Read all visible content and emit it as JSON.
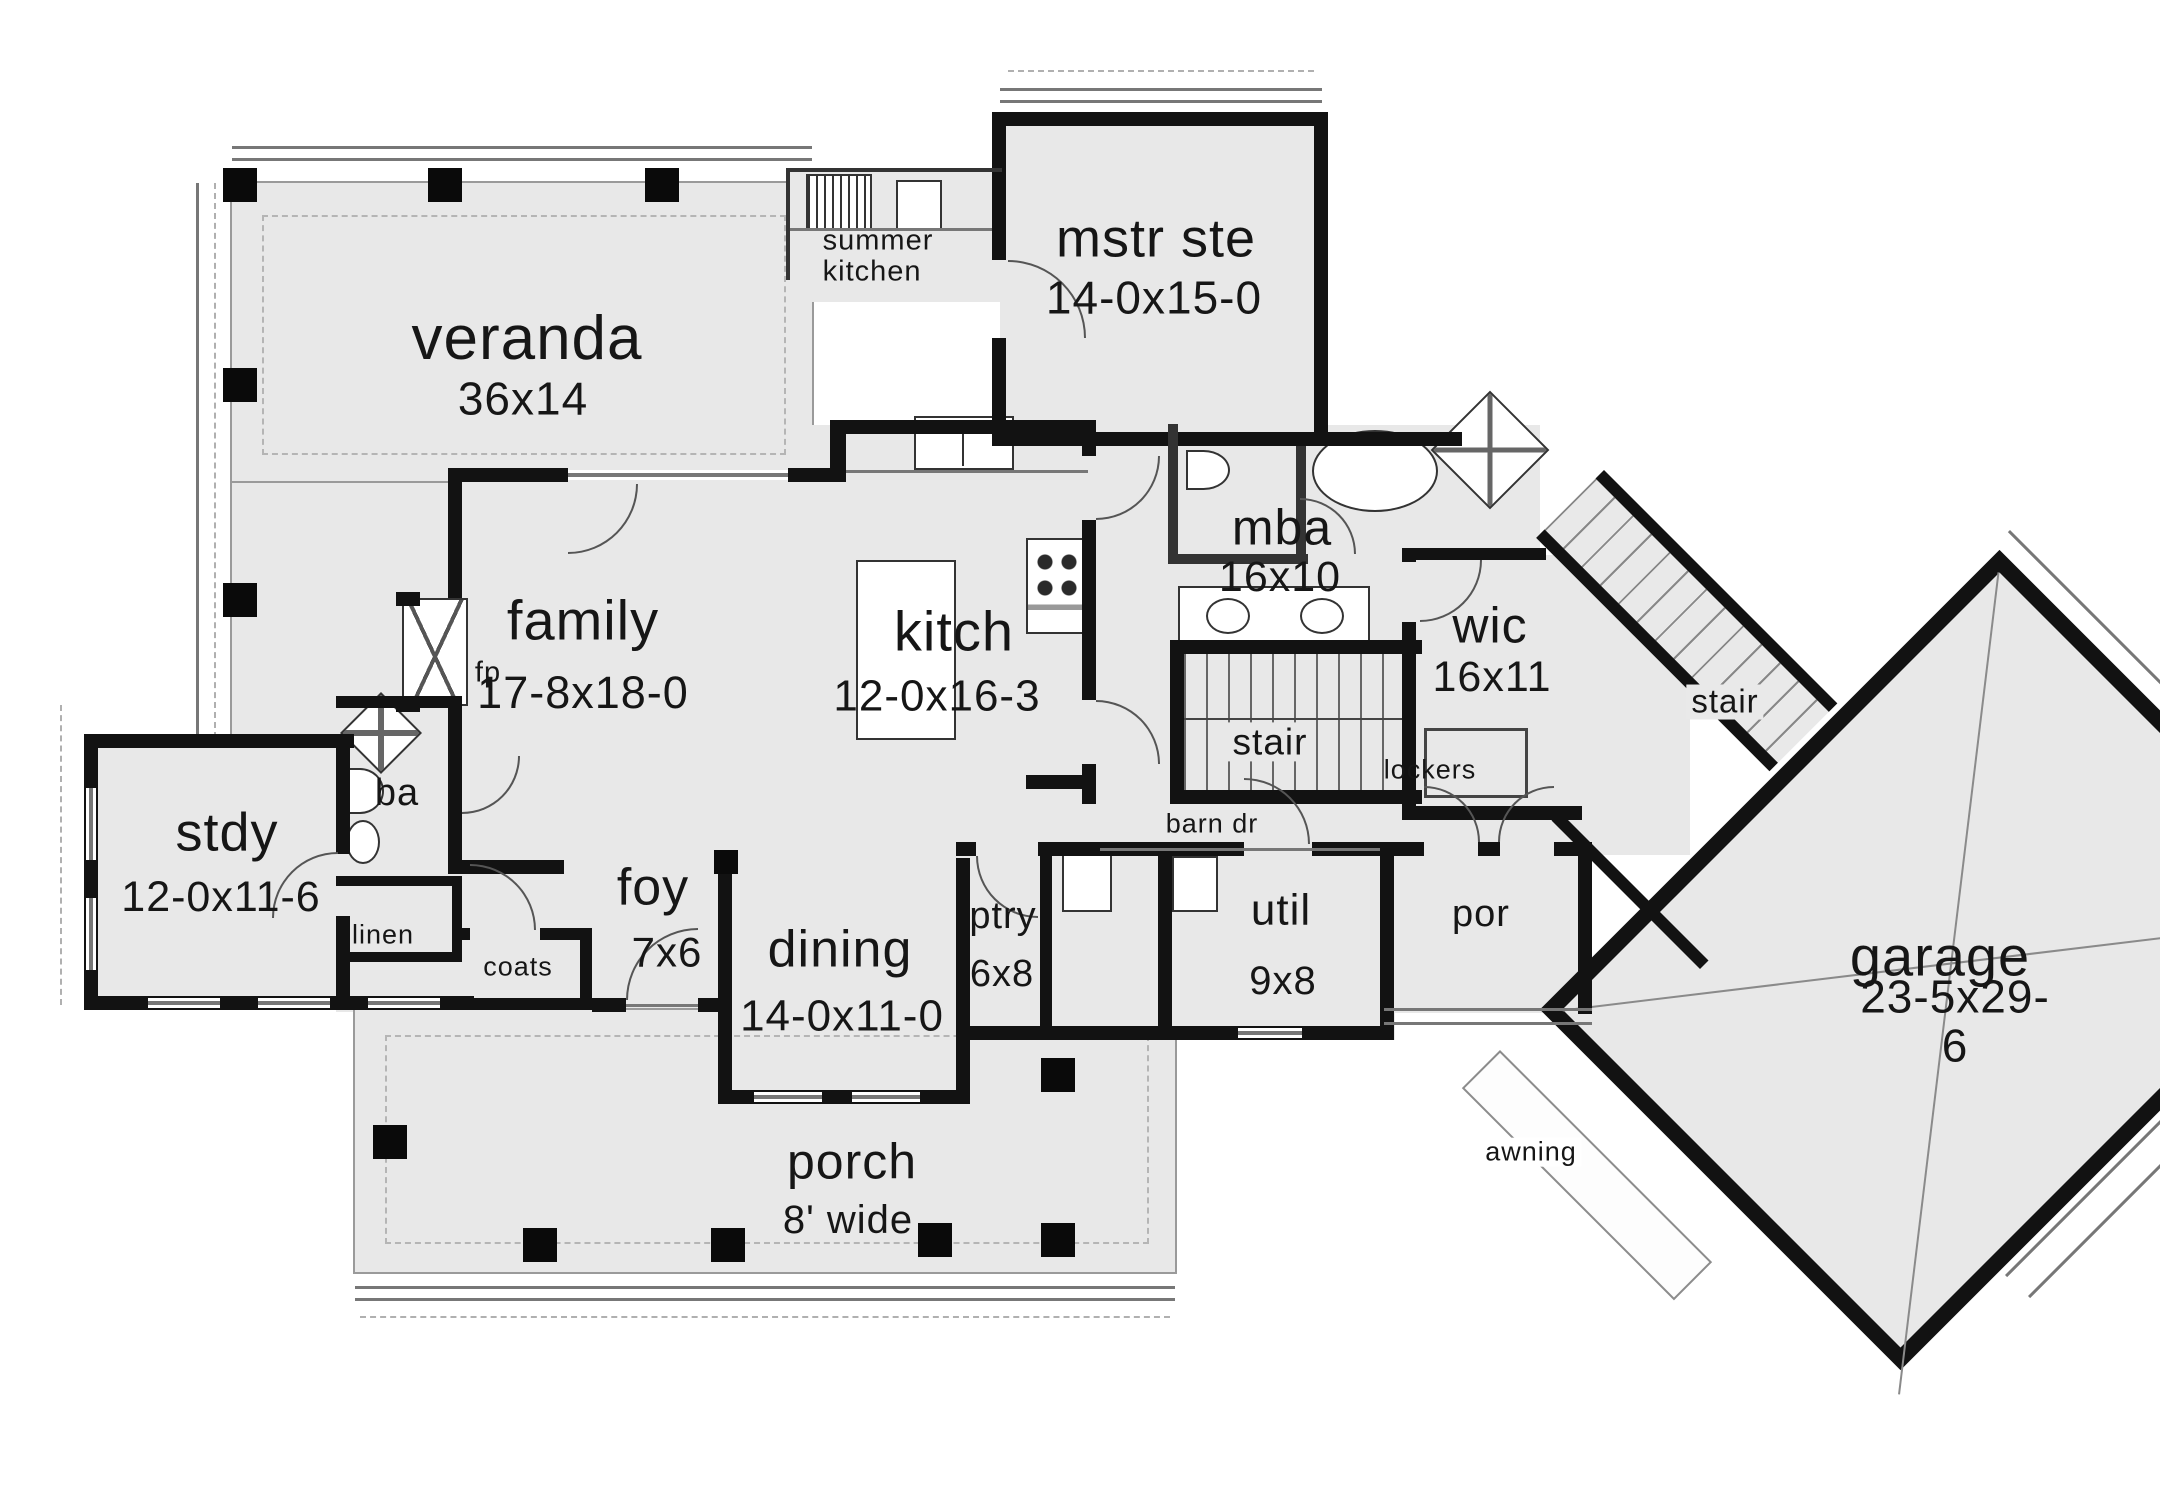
{
  "colors": {
    "background": "#ffffff",
    "room_fill": "#e8e8e8",
    "wall": "#121212",
    "thin_line": "#777777",
    "text": "#161616"
  },
  "rooms": {
    "veranda": {
      "name": "veranda",
      "dims": "36x14"
    },
    "summer_kitchen": {
      "name": "summer\nkitchen"
    },
    "mstr_ste": {
      "name": "mstr ste",
      "dims": "14-0x15-0"
    },
    "family": {
      "name": "family",
      "dims": "17-8x18-0"
    },
    "kitch": {
      "name": "kitch",
      "dims": "12-0x16-3"
    },
    "fp": {
      "name": "fp"
    },
    "ba": {
      "name": "ba"
    },
    "mba": {
      "name": "mba",
      "dims": "16x10"
    },
    "wic": {
      "name": "wic",
      "dims": "16x11"
    },
    "stair_main": {
      "name": "stair"
    },
    "lockers": {
      "name": "lockers"
    },
    "barn_dr": {
      "name": "barn dr"
    },
    "stdy": {
      "name": "stdy",
      "dims": "12-0x11-6"
    },
    "linen": {
      "name": "linen"
    },
    "coats": {
      "name": "coats"
    },
    "foy": {
      "name": "foy",
      "dims": "7x6"
    },
    "dining": {
      "name": "dining",
      "dims": "14-0x11-0"
    },
    "ptry": {
      "name": "ptry",
      "dims": "6x8"
    },
    "util": {
      "name": "util",
      "dims": "9x8"
    },
    "por": {
      "name": "por"
    },
    "porch": {
      "name": "porch",
      "dims": "8' wide"
    },
    "garage": {
      "name": "garage",
      "dims": "23-5x29-6"
    },
    "awning": {
      "name": "awning"
    },
    "stair_garage": {
      "name": "stair"
    }
  }
}
